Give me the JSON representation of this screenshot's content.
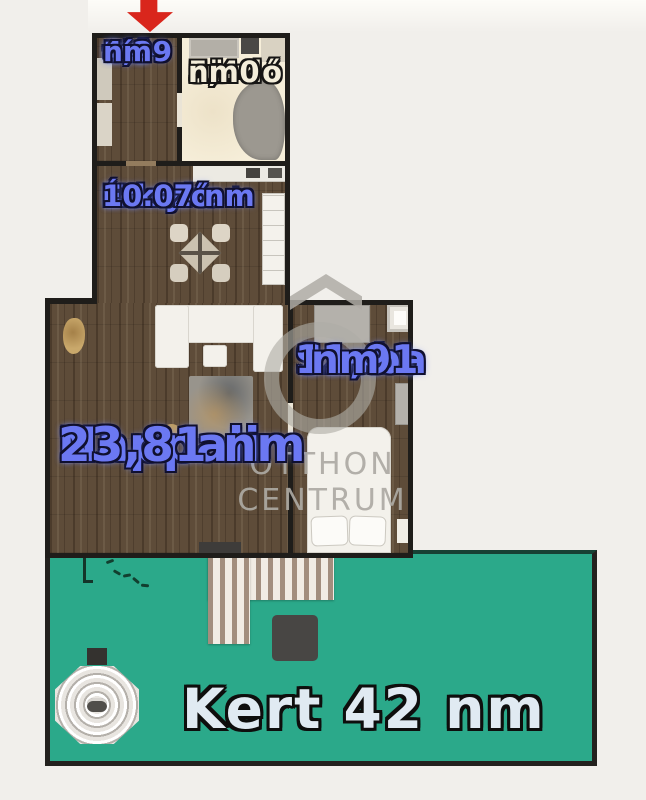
{
  "plan": {
    "type": "apartment-floor-plan",
    "unit": "nm",
    "rooms": {
      "eloter": {
        "name": "Előtér",
        "area": "4,29 nm",
        "lines": [
          "Elő-",
          "tér",
          "4,29",
          "nm"
        ]
      },
      "furdo": {
        "name": "Fürdő",
        "area": "5,40 nm",
        "lines": [
          "Fürdő",
          "5,40",
          "nm"
        ]
      },
      "konyha": {
        "name": "Konyha+Étkező",
        "area": "10.07 nm",
        "lines": [
          "Konyha+",
          "Étkező",
          "10.07 nm"
        ]
      },
      "nappali": {
        "name": "Nappali",
        "area": "23,81 nm",
        "lines": [
          "Nappali",
          "23,81 nm"
        ]
      },
      "szoba": {
        "name": "Szoba",
        "area": "11,91 nm",
        "lines": [
          "Szoba",
          "11,91",
          "nm"
        ]
      },
      "kert": {
        "name": "Kert",
        "area": "42 nm",
        "label": "Kert 42 nm"
      }
    },
    "annotations": {
      "entrance_arrow": "red-down-arrow-marking-entrance"
    },
    "watermark": {
      "line1": "OTTHON",
      "line2": "CENTRUM"
    },
    "colors": {
      "background": "#f1efeb",
      "wall": "#1f1d1a",
      "wood_floor": "#5e4c39",
      "bath_floor": "#f6eed9",
      "garden_green": "#2ba98a",
      "label_blue": "#6b78f2",
      "label_cream": "#f3edda",
      "label_light": "#e0eaf2",
      "arrow_red": "#d9261c",
      "watermark_gray": "#afada8"
    }
  }
}
